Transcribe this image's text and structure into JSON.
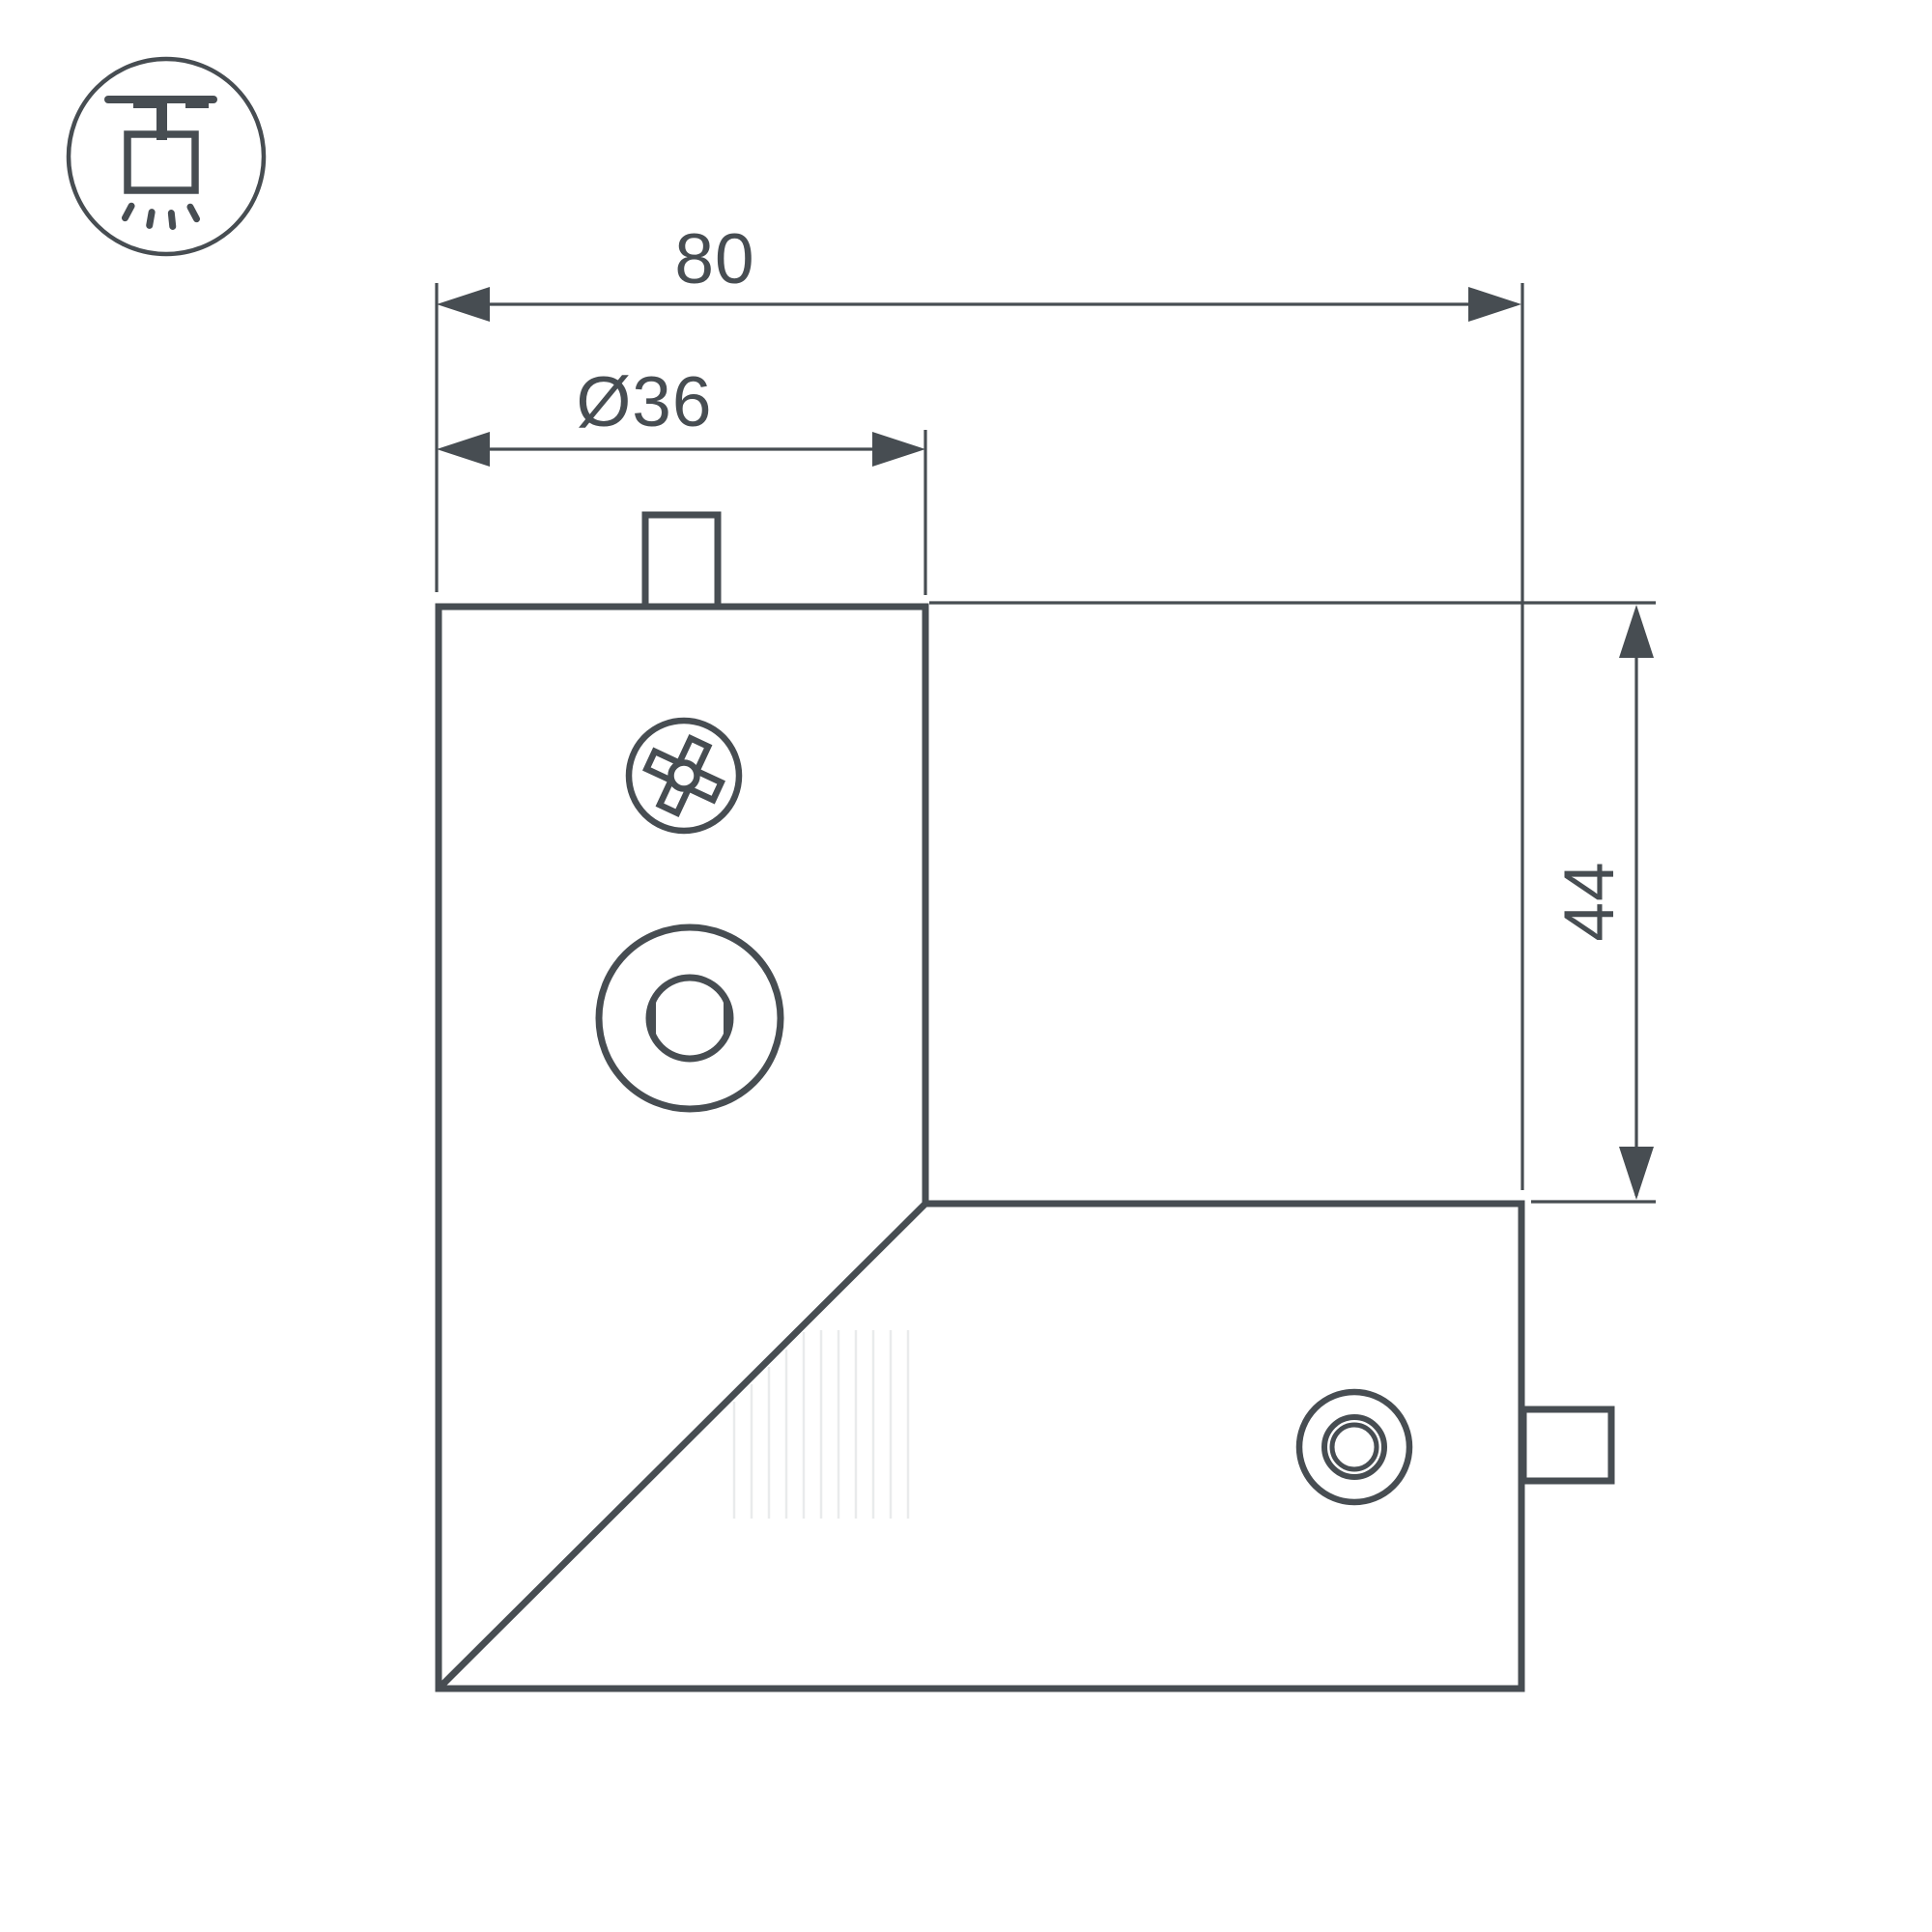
{
  "colors": {
    "line": "#474D52",
    "background": "#FFFFFF",
    "shading": "#E9EBEC"
  },
  "icon": {
    "name": "ceiling-mounted-track-light"
  },
  "dimensions": {
    "total_width": {
      "label": "80"
    },
    "body_diameter": {
      "label": "Ø36"
    },
    "arm_height": {
      "label": "44"
    }
  }
}
